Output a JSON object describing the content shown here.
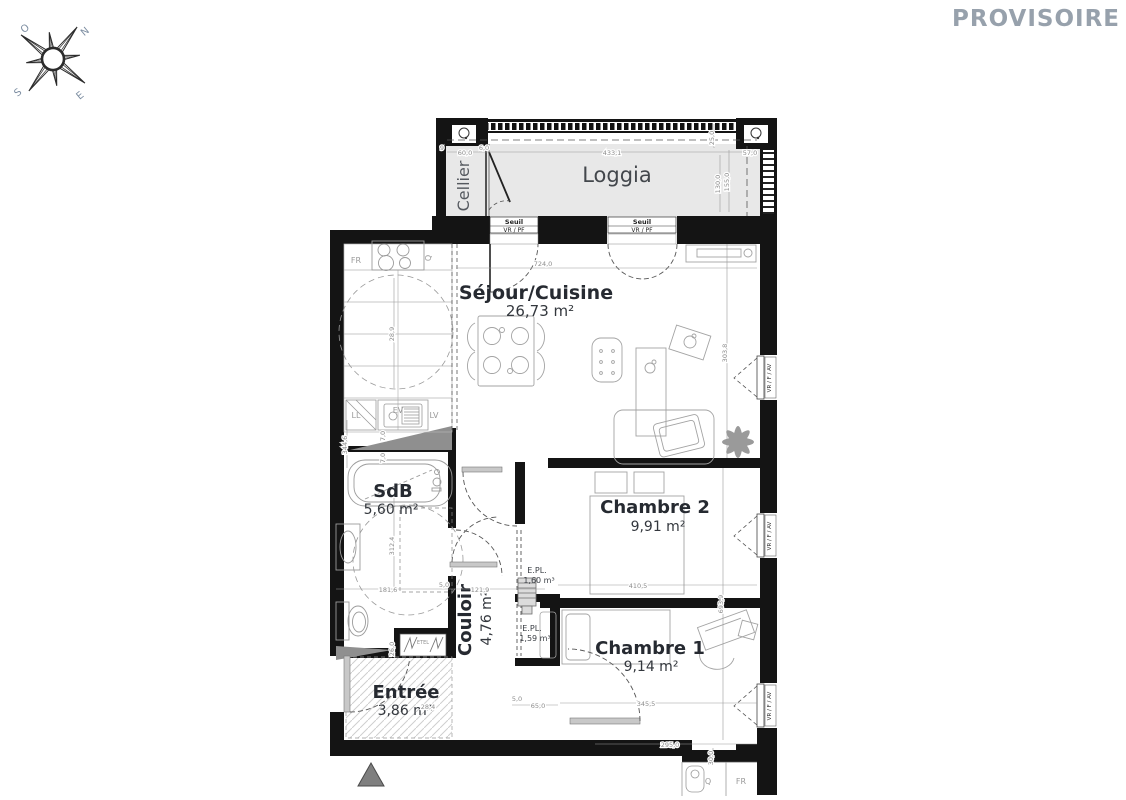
{
  "watermark": "PROVISOIRE",
  "compass": {
    "n": "N",
    "e": "E",
    "s": "S",
    "o": "O"
  },
  "colors": {
    "wall": "#141414",
    "loggia_floor": "#e8e8e8",
    "label": "#262a31",
    "dimension": "#8c8c8c",
    "watermark": "#97a1ac",
    "shaft_gray": "#8f8f8f"
  },
  "rooms": {
    "loggia": {
      "name": "Loggia"
    },
    "cellier": {
      "name": "Cellier"
    },
    "sejour": {
      "name": "Séjour/Cuisine",
      "area": "26,73 m²"
    },
    "sdb": {
      "name": "SdB",
      "area": "5,60 m²"
    },
    "chambre2": {
      "name": "Chambre 2",
      "area": "9,91 m²"
    },
    "chambre1": {
      "name": "Chambre 1",
      "area": "9,14 m²"
    },
    "couloir": {
      "name": "Couloir",
      "area": "4,76 m²"
    },
    "entree": {
      "name": "Entrée",
      "area": "3,86 m²"
    },
    "epl1": {
      "name": "E.PL.",
      "area": "1,60 m³"
    },
    "epl2": {
      "name": "E.PL.",
      "area": "1,59 m³"
    }
  },
  "thresholds": {
    "label": "Seuil",
    "type": "VR / PF"
  },
  "window_label": "VR / F / AV",
  "appliances": {
    "fr": "FR",
    "ll": "LL",
    "ev": "EV",
    "lv": "LV",
    "etel": "ETEL",
    "q_kitchen": "Q",
    "neighbor_fr": "FR",
    "neighbor_q": "Q"
  },
  "dimensions": {
    "sejour_w": "724,0",
    "loggia_w": "433,1",
    "cellier_w": "60,0",
    "cellier_gap": "6,0",
    "right_off": "57,0",
    "tiny9": "9",
    "loggia_d1": "130,0",
    "loggia_d2": "155,0",
    "loggia_d3": "25,0",
    "sejour_d": "303,8",
    "ch2_w": "410,5",
    "ch1_w": "345,5",
    "bottom_w": "295,0",
    "sdb_w": "181,6",
    "wall5": "5,0",
    "couloir_w": "121,9",
    "sdb_d": "312,4",
    "kitchen_d": "344,6",
    "kitchen_w": "28,9",
    "chambers_d": "693,9",
    "door5": "5,0",
    "door65": "65,0",
    "w7a": "7,0",
    "w7b": "7,0",
    "d26": "26,0",
    "d284": "28,4",
    "d30": "30,0"
  }
}
